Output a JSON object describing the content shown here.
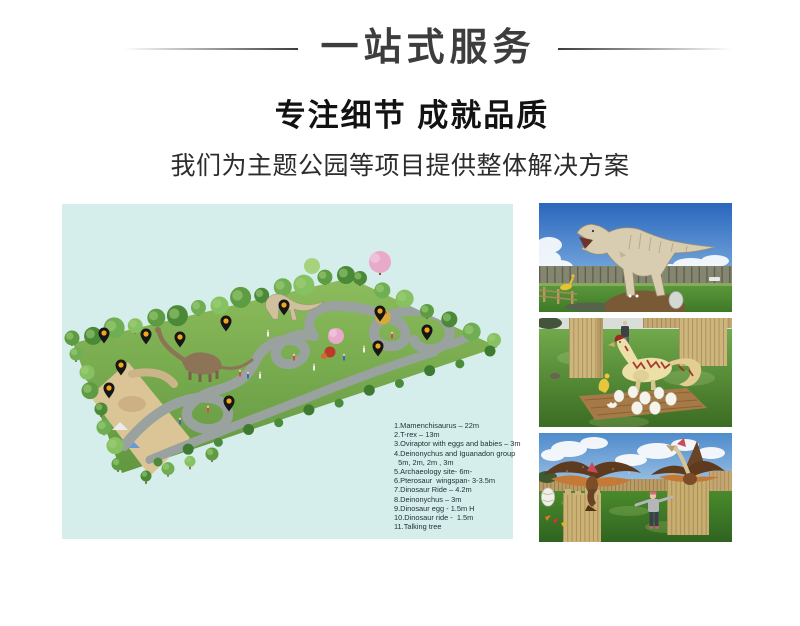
{
  "header": {
    "title": "一站式服务",
    "subtitle": "专注细节 成就品质",
    "tagline": "我们为主题公园等项目提供整体解决方案"
  },
  "colors": {
    "map_bg": "#d5eeeb",
    "pin_body": "#161616",
    "pin_dot": "#f2a61c",
    "title_color": "#3d3d3d",
    "subtitle_color": "#121212"
  },
  "map": {
    "legend_items": [
      "1.Mamenchisaurus – 22m",
      "2.T-rex – 13m",
      "3.Oviraptor with eggs and babies – 3m",
      "4.Deinonychus and Iguanadon group",
      "  5m, 2m, 2m , 3m",
      "5.Archaeology site- 6m-",
      "6.Pterosaur  wingspan- 3-3.5m",
      "7.Dinosaur Ride – 4.2m",
      "8.Deinonychus – 3m",
      "9.Dinosaur egg - 1.5m H",
      "10.Dinosaur ride -  1.5m",
      "11.Talking tree"
    ],
    "pins": [
      {
        "x": 36,
        "y": 123
      },
      {
        "x": 78,
        "y": 124
      },
      {
        "x": 112,
        "y": 127
      },
      {
        "x": 158,
        "y": 111
      },
      {
        "x": 216,
        "y": 95
      },
      {
        "x": 312,
        "y": 101
      },
      {
        "x": 310,
        "y": 136
      },
      {
        "x": 359,
        "y": 120
      },
      {
        "x": 53,
        "y": 155
      },
      {
        "x": 41,
        "y": 178
      },
      {
        "x": 161,
        "y": 191
      }
    ]
  },
  "photos": [
    {
      "name": "trex-model-photo"
    },
    {
      "name": "oviraptor-eggs-photo"
    },
    {
      "name": "pterosaur-models-photo"
    }
  ]
}
